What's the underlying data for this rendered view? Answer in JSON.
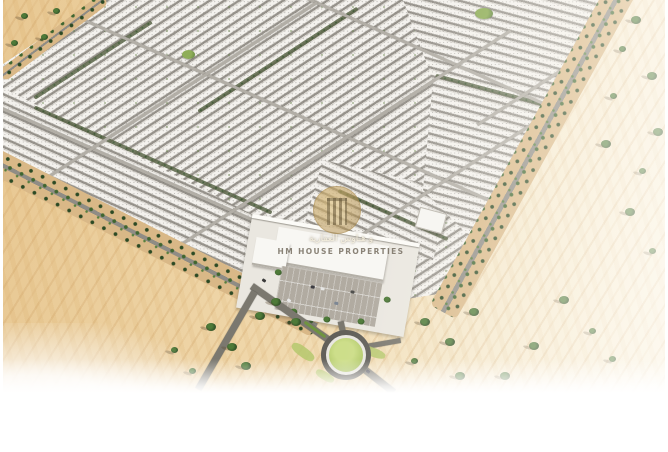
{
  "scene": {
    "alt": "Aerial 3D masterplan rendering of a desert residential community: dense rows of white townhouses bordered by palm-lined roads, a central community building with parking lot, and a landscaped roundabout at the main entrance surrounded by open sand."
  },
  "watermark": {
    "arabic_line": "و هـاوس العقارية",
    "latin_line": "HM HOUSE PROPERTIES"
  },
  "palette": {
    "sand": "#ecd3a6",
    "sand_streak": "#d0a468",
    "housing_white": "#f4f2ee",
    "street_gray": "#a5a19a",
    "palm_green_dark": "#2c4a24",
    "palm_green": "#477036",
    "grass_green": "#b5c86d",
    "asphalt": "#62605a",
    "logo_gold": "#c2a25e"
  }
}
